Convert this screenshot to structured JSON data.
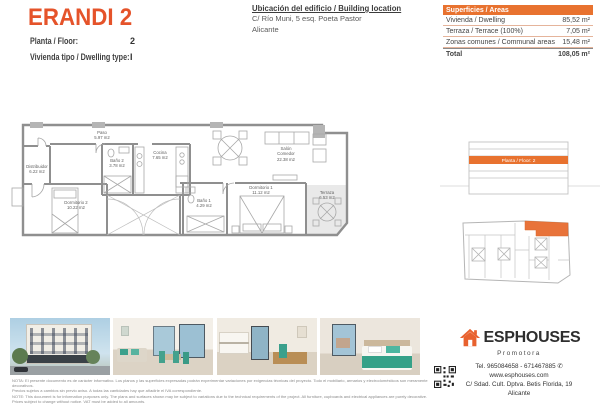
{
  "colors": {
    "accent": "#E5532A",
    "accent_table": "#E8722F",
    "accent_plan": "#E8733A"
  },
  "header": {
    "title": "ERANDI 2",
    "fields": [
      {
        "label": "Planta / Floor:",
        "value": "2"
      },
      {
        "label": "Vivienda tipo / Dwelling type:",
        "value": "I"
      }
    ],
    "location": {
      "title": "Ubicación del edificio / Building location",
      "line1": "C/ Río Muni, 5 esq. Poeta Pastor",
      "line2": "Alicante"
    }
  },
  "areas": {
    "header": "Superficies / Areas",
    "rows": [
      {
        "label": "Vivienda / Dwelling",
        "value": "85,52 m²"
      },
      {
        "label": "Terraza / Terrace (100%)",
        "value": "7,05 m²"
      },
      {
        "label": "Zonas comunes / Communal areas",
        "value": "15,48 m²"
      }
    ],
    "total": {
      "label": "Total",
      "value": "108,05 m²"
    }
  },
  "plan": {
    "rooms": [
      {
        "name": "Distribuidor",
        "area": "6.22 m2"
      },
      {
        "name": "Paso",
        "area": "5.97 m2"
      },
      {
        "name": "Baño 2",
        "area": "3.78 m2"
      },
      {
        "name": "Cocina",
        "area": "7.65 m2"
      },
      {
        "name": "Dormitorio 2",
        "area": "10.22 m2"
      },
      {
        "name": "Salón",
        "name2": "Comedor",
        "area": "22.38 m2"
      },
      {
        "name": "Dormitorio 1",
        "area": "11.12 m2"
      },
      {
        "name": "Baño 1",
        "area": "4.29 m2"
      },
      {
        "name": "Terraza",
        "area": "6.53 m2"
      }
    ]
  },
  "section_diagram": {
    "label": "Planta / Floor: 2"
  },
  "footer": {
    "brand": "ESPHOUSES",
    "tagline": "Promotora",
    "phone": "Tel. 965084658 - 671467885",
    "website": "www.esphouses.com",
    "address": "C/ Sdad. Cult. Dptva. Betis Florida, 19",
    "city": "Alicante"
  },
  "icons": {
    "phone": "✆"
  },
  "disclaimer": {
    "line1": "NOTA: El presente documento es de carácter informativo. Los planos y las superficies expresadas podrán experimentar variaciones por exigencias técnicas del proyecto. Todo el mobiliario, armarios y electrodomésticos son meramente decorativos.",
    "line2": "Precios sujetos a cambios sin previo aviso. A todas las cantidades hay que añadirle el IVA correspondiente.",
    "line3": "NOTE: This document is for information purposes only. The plans and surfaces shown may be subject to variations due to the technical requirements of the project. All furniture, cupboards and electrical appliances are purely decorative.",
    "line4": "Prices subject to change without notice. VAT must be added to all amounts."
  }
}
